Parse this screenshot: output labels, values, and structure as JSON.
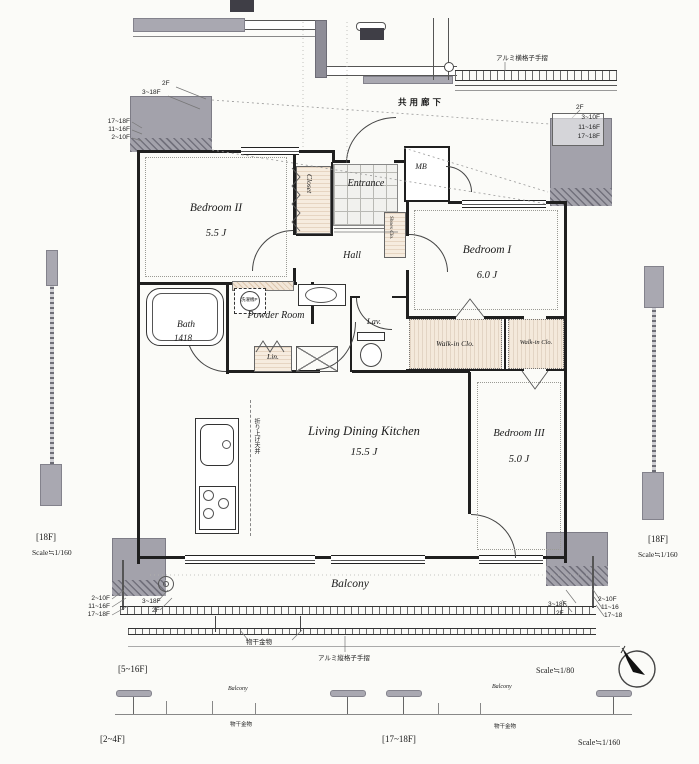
{
  "corridor": "共用廊下",
  "rooms": {
    "bedroom2": {
      "name": "Bedroom II",
      "size": "5.5 J"
    },
    "bedroom1": {
      "name": "Bedroom I",
      "size": "6.0 J"
    },
    "bedroom3": {
      "name": "Bedroom III",
      "size": "5.0 J"
    },
    "ldk": {
      "name": "Living Dining Kitchen",
      "size": "15.5 J"
    },
    "entrance": {
      "name": "Entrance"
    },
    "hall": {
      "name": "Hall"
    },
    "bath": {
      "name": "Bath",
      "size": "1418"
    },
    "powder": {
      "name": "Powder Room"
    },
    "lav": {
      "name": "Lav."
    },
    "lin": {
      "name": "Lin."
    },
    "closet": {
      "name": "Closet"
    },
    "shoes": {
      "name": "Shoes Clo."
    },
    "mb": {
      "name": "MB"
    },
    "wic1": {
      "name": "Walk-in Clo."
    },
    "wic2": {
      "name": "Walk-in Clo."
    },
    "balcony": {
      "name": "Balcony"
    }
  },
  "annotations": {
    "coffered_ceiling": "折り上げ天井",
    "washer": "洗濯機P",
    "laundry_hardware": "物干金物",
    "rail_vertical": "アルミ縦格子手摺",
    "rail_horizontal": "アルミ横格子手摺"
  },
  "callouts": {
    "tl_top": [
      "2F",
      "3~18F"
    ],
    "tl_side": [
      "17~18F",
      "11~16F",
      "2~10F"
    ],
    "tr_top": "2F",
    "tr_box": [
      "3~10F",
      "11~16F",
      "17~18F"
    ],
    "bl_side": [
      "2~10F",
      "11~16F",
      "17~18F"
    ],
    "bl_below": [
      "3~18F",
      "2F"
    ],
    "br_below": [
      "3~18F",
      "2F"
    ],
    "br_side": [
      "2~10F",
      "11~16",
      "17~18"
    ]
  },
  "legends": {
    "left": {
      "floor": "[18F]",
      "scale": "Scale≒1/160"
    },
    "right": {
      "floor": "[18F]",
      "scale": "Scale≒1/160"
    },
    "bottom": {
      "range_a": "[5~16F]",
      "range_b": "[2~4F]",
      "range_c": "[17~18F]",
      "scale_80": "Scale≒1/80",
      "scale_160": "Scale≒1/160",
      "balcony_a": "Balcony",
      "balcony_b": "Balcony",
      "note_a": "物干金物",
      "note_b": "物干金物"
    }
  }
}
